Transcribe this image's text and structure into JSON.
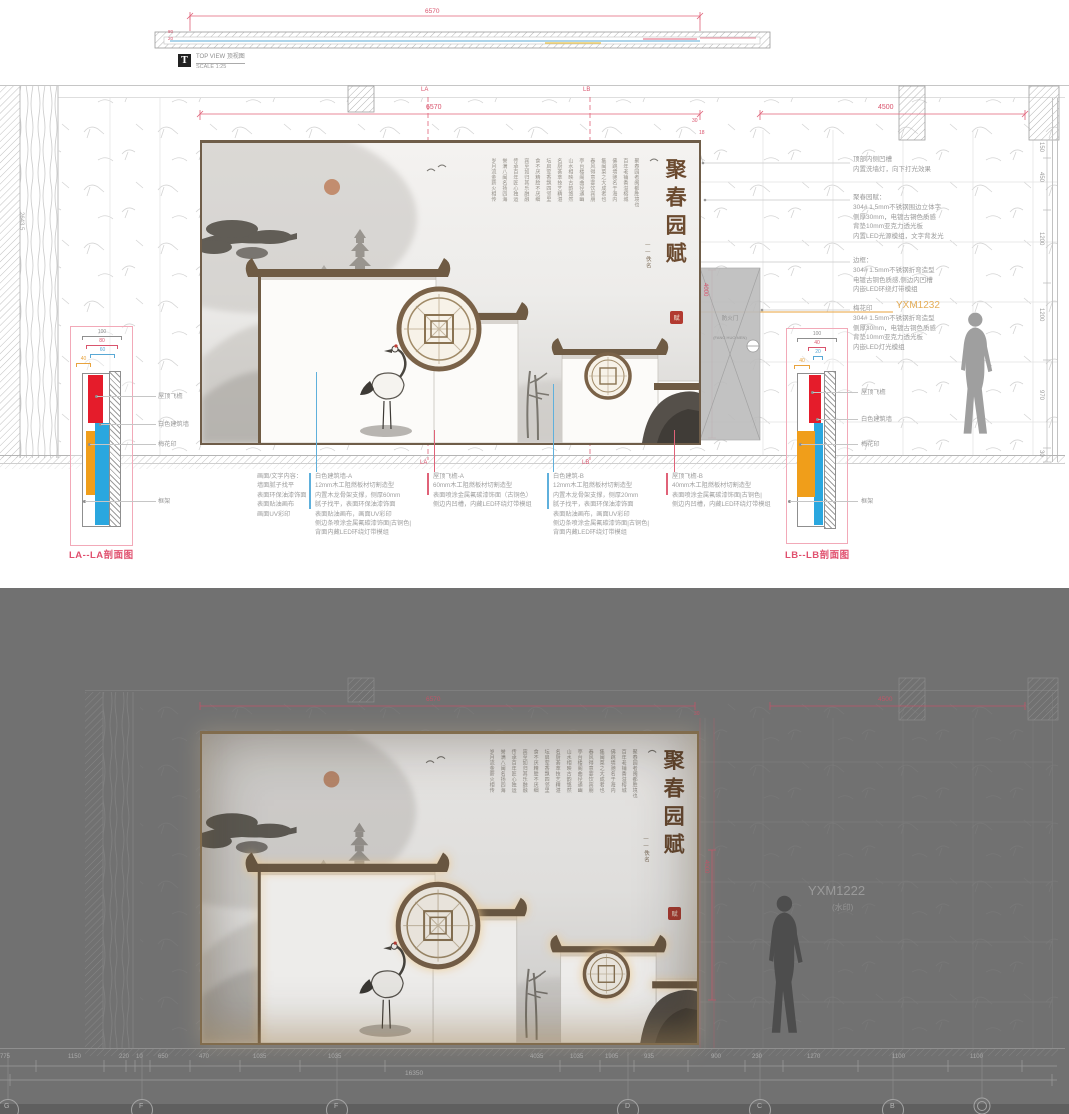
{
  "colors": {
    "dim_red": "#d9546d",
    "accent_blue": "#2aa7df",
    "accent_orange": "#f09e1a",
    "bar_red": "#e51c2b",
    "roof_brown": "#6f5b44",
    "title_brown": "#6b4a2f",
    "seal_red": "#b23a30",
    "watermark_orange": "#e2a13c",
    "dark_bg": "#717171"
  },
  "top_view": {
    "badge": "T",
    "label": "TOP VIEW   顶视图",
    "scale": "SCALE 1:25",
    "dim": "6570",
    "side_dims": [
      "80",
      "20"
    ]
  },
  "elevation": {
    "dim_width": "6570",
    "dim_right": "4500",
    "marker_la": "LA",
    "marker_lb": "LB",
    "dim_gap": "30",
    "dim_gap2": "18",
    "dim_door": "4000",
    "left_dim": "2643.5",
    "right_dims": [
      "150",
      "450",
      "1200",
      "1200",
      "970",
      "30"
    ],
    "door_label": "防火门",
    "door_sub": "(FANG HUO MEN)",
    "watermark": "YXM1232"
  },
  "artwork": {
    "title": "聚春园赋",
    "signature": "——佚名",
    "seal_char": "赋",
    "poem_columns_decorative_illegible": [
      "聚春园者闽都胜境也",
      "百年老铺香溢榕城",
      "佛跳墙驰名于海内",
      "集闽菜之大成者也",
      "春风得意宴饮宾朋",
      "亭台楼阁曲径通幽",
      "山水相映古韵悠然",
      "名厨荟萃技艺精湛",
      "坛启荤香飘四邻里",
      "食不厌精脍不厌细",
      "宾至如归其乐融融",
      "传承百年匠心独运",
      "誉满八闽名扬四海",
      "岁月流金薪火相传"
    ]
  },
  "annotations_right": [
    {
      "title": "顶部内侧凹槽",
      "lines": [
        "内置洗墙灯，向下打光效果"
      ]
    },
    {
      "title": "聚春园赋：",
      "lines": [
        "304# 1.5mm不锈钢围边立体字",
        "侧厚30mm，电镀古铜色质感",
        "背垫10mm亚克力透光板",
        "内置LED光源模组，文字背发光"
      ]
    },
    {
      "title": "边框：",
      "lines": [
        "304# 1.5mm不锈钢折弯造型",
        "电镀古铜色质感,侧边内凹槽",
        "内嵌LED环绕灯带模组"
      ]
    },
    {
      "title": "梅花印",
      "lines": [
        "304# 1.5mm不锈钢折弯造型",
        "侧厚30mm，电镀古铜色质感",
        "背垫10mm亚克力透光板",
        "内嵌LED灯光模组"
      ]
    }
  ],
  "annotations_bottom": [
    {
      "accent": "none",
      "title": "画面/文字内容：",
      "lines": [
        "墙面腻子找平",
        "表面环保油漆饰面",
        "表面贴油画布",
        "画面UV彩印"
      ]
    },
    {
      "accent": "blue",
      "title": "白色建筑墙-A",
      "lines": [
        "12mm木工阻燃板材切割造型",
        "内置木龙骨架支撑，侧厚60mm",
        "腻子找平，表面环保油漆饰面",
        "表面贴油画布，画面UV彩印",
        "侧边条喷涂金属氟碳漆饰面|古铜色|",
        "背面内藏LED环绕灯带模组"
      ]
    },
    {
      "accent": "red",
      "title": "屋顶飞檐-A",
      "lines": [
        "60mm木工阻燃板材切割造型",
        "表面喷涂金属氟碳漆饰面（古铜色）",
        "侧边内凹槽，内藏LED环绕灯带模组"
      ]
    },
    {
      "accent": "blue",
      "title": "白色建筑-B",
      "lines": [
        "12mm木工阻燃板材切割造型",
        "内置木龙骨架支撑，侧厚20mm",
        "腻子找平，表面环保油漆饰面",
        "表面贴油画布，画面UV彩印",
        "侧边条喷涂金属氟碳漆饰面|古铜色|",
        "背面内藏LED环绕灯带模组"
      ]
    },
    {
      "accent": "red",
      "title": "屋顶飞檐-B",
      "lines": [
        "40mm木工阻燃板材切割造型",
        "表面喷涂金属氟碳漆饰面|古铜色|",
        "侧边内凹槽，内藏LED环绕灯带模组"
      ]
    }
  ],
  "sections": {
    "la": {
      "title": "LA--LA剖面图",
      "dims": [
        "100",
        "80",
        "60",
        "40"
      ],
      "labels": [
        "屋顶飞檐",
        "白色建筑墙",
        "梅花印",
        "框架"
      ]
    },
    "lb": {
      "title": "LB--LB剖面图",
      "dims": [
        "100",
        "40",
        "20",
        "40"
      ],
      "labels": [
        "屋顶飞檐",
        "白色建筑墙",
        "梅花印",
        "框架"
      ]
    }
  },
  "render": {
    "dim_width": "6570",
    "dim_right": "4500",
    "dim_gap": "30",
    "dim_door": "4000",
    "watermark": "YXM1222",
    "watermark_note": "(水印)",
    "bottom_dims": [
      "775",
      "1150",
      "220",
      "10",
      "650",
      "470",
      "1035",
      "1035",
      "4035",
      "1035",
      "1905",
      "935",
      "900",
      "230",
      "1270",
      "1100",
      "1100"
    ],
    "total_dim": "16350",
    "grid_bubbles": [
      "G",
      "F",
      "F",
      "D",
      "C",
      "B"
    ]
  }
}
